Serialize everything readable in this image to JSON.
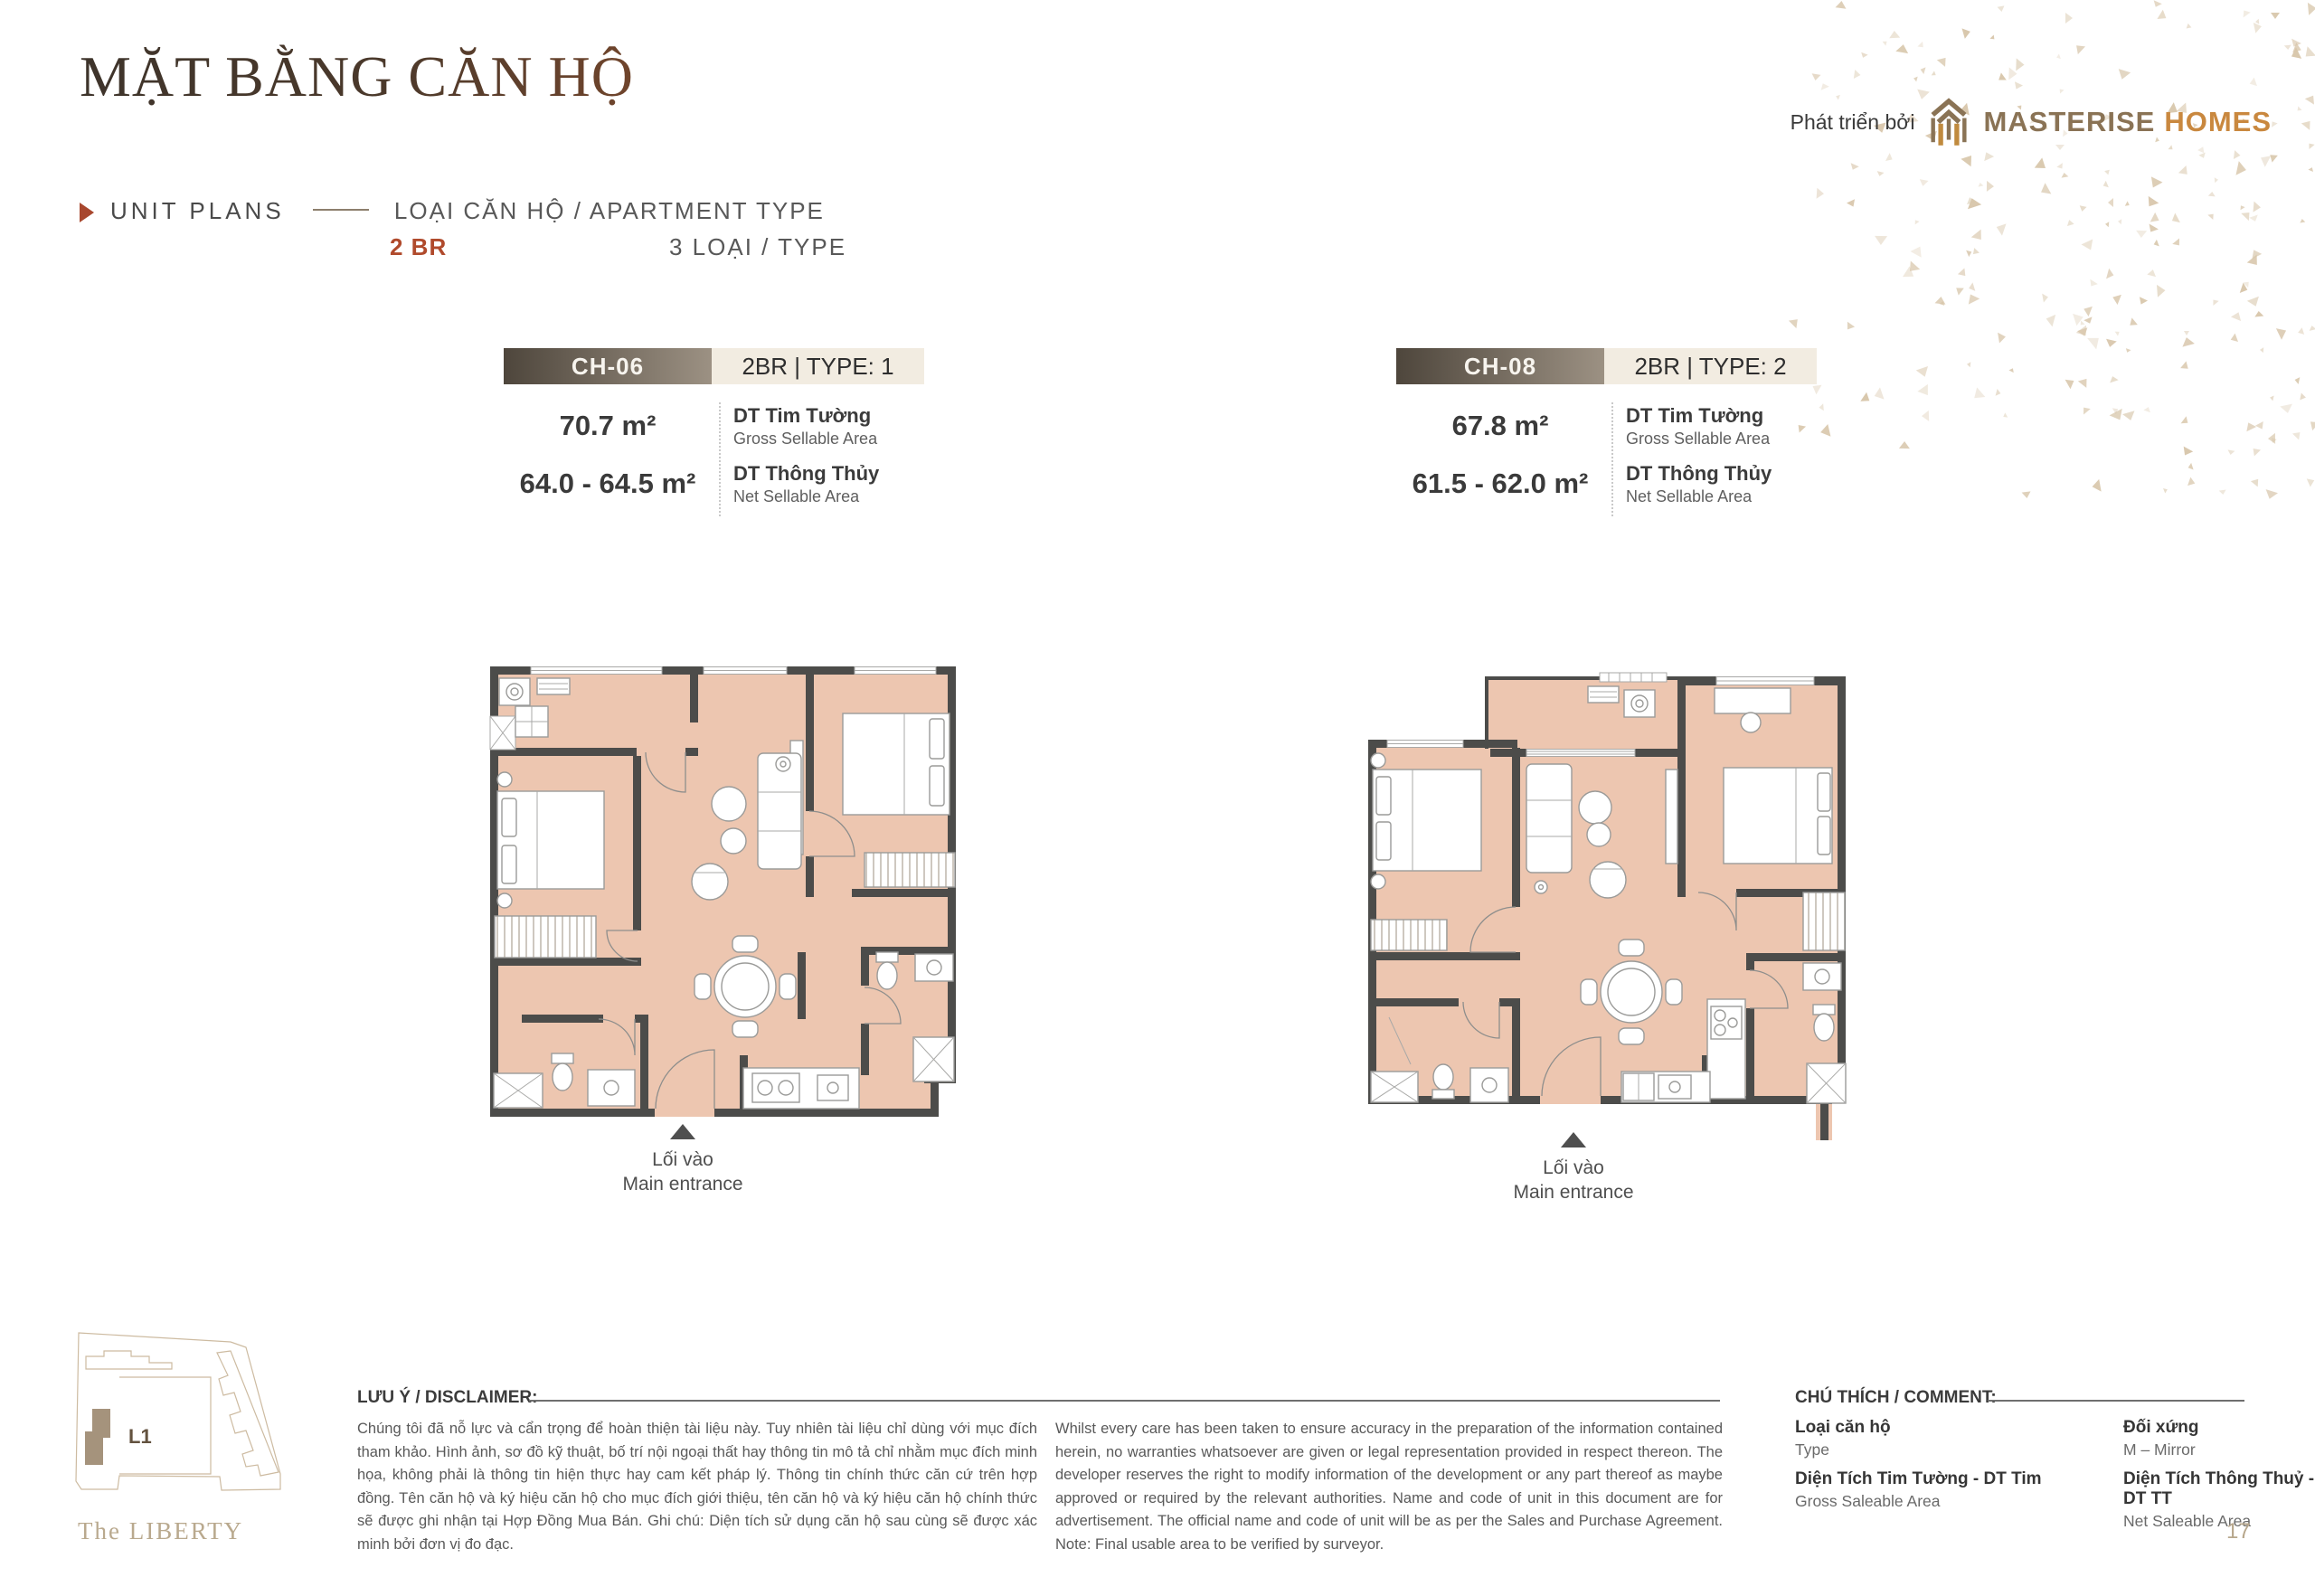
{
  "header": {
    "title": "MẶT BẰNG CĂN HỘ",
    "subtitle_left": "UNIT PLANS",
    "subtitle_right": "LOẠI CĂN HỘ / APARTMENT TYPE",
    "bedroom_tag": "2 BR",
    "type_count": "3 LOẠI / TYPE",
    "developer_label": "Phát triển bởi",
    "brand_word_1": "MASTERISE",
    "brand_word_2": "HOMES"
  },
  "units": [
    {
      "code": "CH-06",
      "type_label": "2BR | TYPE: 1",
      "gross_area": "70.7 m²",
      "net_area": "64.0 - 64.5 m²",
      "gross_label_vi": "DT Tim Tường",
      "gross_label_en": "Gross Sellable Area",
      "net_label_vi": "DT Thông Thủy",
      "net_label_en": "Net Sellable Area",
      "entrance_vi": "Lối vào",
      "entrance_en": "Main entrance"
    },
    {
      "code": "CH-08",
      "type_label": "2BR | TYPE: 2",
      "gross_area": "67.8 m²",
      "net_area": "61.5 - 62.0 m²",
      "gross_label_vi": "DT Tim Tường",
      "gross_label_en": "Gross Sellable Area",
      "net_label_vi": "DT Thông Thủy",
      "net_label_en": "Net Sellable Area",
      "entrance_vi": "Lối vào",
      "entrance_en": "Main entrance"
    }
  ],
  "site_plan": {
    "building_label": "L1",
    "project_name": "The LIBERTY"
  },
  "disclaimer": {
    "heading": "LƯU Ý / DISCLAIMER:",
    "text_vi": "Chúng tôi đã nỗ lực và cẩn trọng để hoàn thiện tài liệu này. Tuy nhiên tài liệu chỉ dùng với mục đích tham khảo. Hình ảnh, sơ đồ kỹ thuật, bố trí nội ngoại thất hay thông tin mô tả chỉ nhằm mục đích minh họa, không phải là thông tin hiện thực hay cam kết pháp lý. Thông tin chính thức căn cứ trên hợp đồng. Tên căn hộ và ký hiệu căn hộ cho mục đích giới thiệu, tên căn hộ và ký hiệu căn hộ chính thức sẽ được ghi nhận tại Hợp Đồng Mua Bán. Ghi chú: Diện tích sử dụng căn hộ sau cùng sẽ được xác minh bởi đơn vị đo đạc.",
    "text_en": "Whilst every care has been taken to ensure accuracy in the preparation of the information contained herein, no warranties whatsoever are given or legal representation provided in respect thereon. The developer reserves the right to modify information of the development or any part thereof as maybe approved or required by the relevant authorities. Name and code of unit in this document are for advertisement. The official name and code of unit will be as per the Sales and Purchase Agreement. Note: Final usable area to be verified by surveyor."
  },
  "legend": {
    "heading": "CHÚ THÍCH / COMMENT:",
    "items": [
      {
        "vi": "Loại căn hộ",
        "en": "Type"
      },
      {
        "vi": "Đối xứng",
        "en": "M – Mirror"
      },
      {
        "vi": "Diện Tích Tim Tường - DT Tim",
        "en": "Gross Saleable Area"
      },
      {
        "vi": "Diện Tích Thông Thuỷ - DT TT",
        "en": "Net Saleable Area"
      }
    ]
  },
  "footer": {
    "page_number": "17"
  },
  "colors": {
    "accent_red": "#b04a2c",
    "bar_dark": "#4e463c",
    "bar_cream": "#f2ece1",
    "floor_salmon": "#edc6b0",
    "wall_dark": "#4c4c4a",
    "brand_brown": "#8a7355",
    "brand_gold": "#c9883f",
    "beige": "#b7a78c"
  }
}
